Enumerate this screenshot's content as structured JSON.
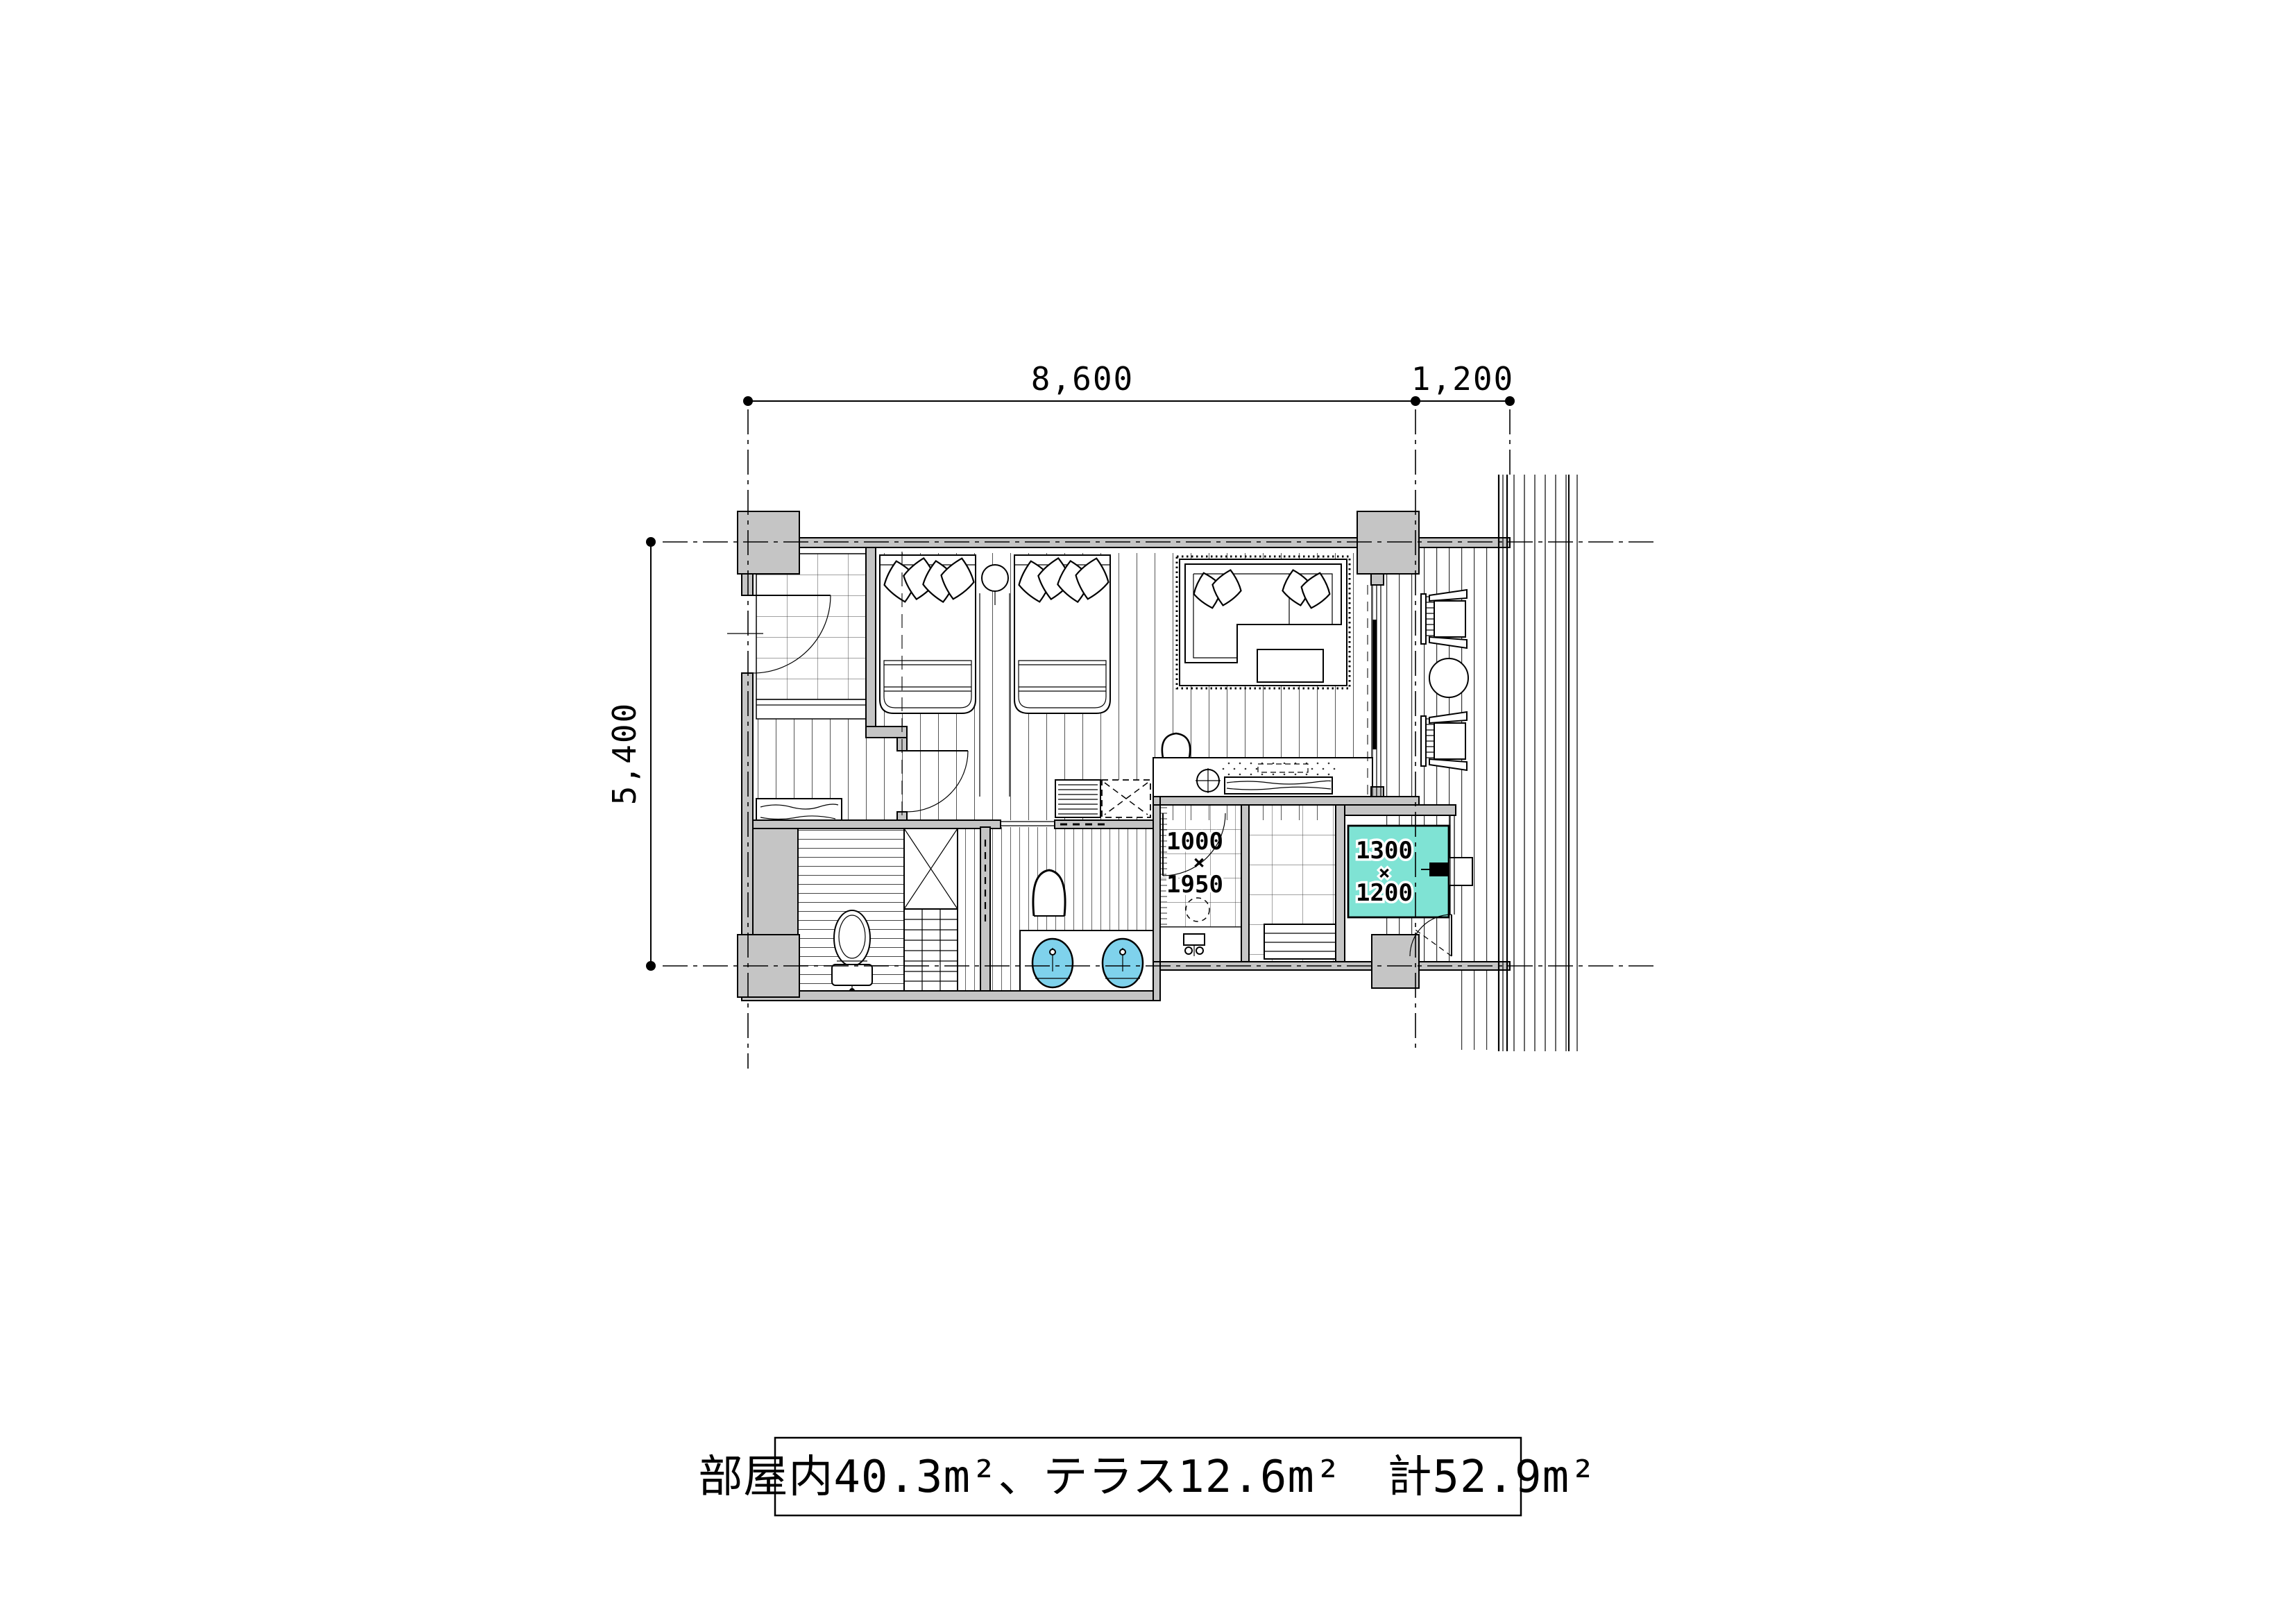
{
  "drawing": {
    "dimensions": {
      "top_main": "8,600",
      "top_terrace": "1,200",
      "left_side": "5,400"
    },
    "room_labels": {
      "bathtub_w": "1300",
      "bathtub_x": "×",
      "bathtub_d": "1200",
      "shower_w": "1000",
      "shower_x": "×",
      "shower_d": "1950"
    },
    "area_note": "部屋内40.3m²、テラス12.6m²　計52.9m²",
    "colors": {
      "bathtub_fill": "#7fe3d4",
      "basin_fill": "#7fd2ec",
      "wall_fill": "#c5c5c5"
    }
  }
}
